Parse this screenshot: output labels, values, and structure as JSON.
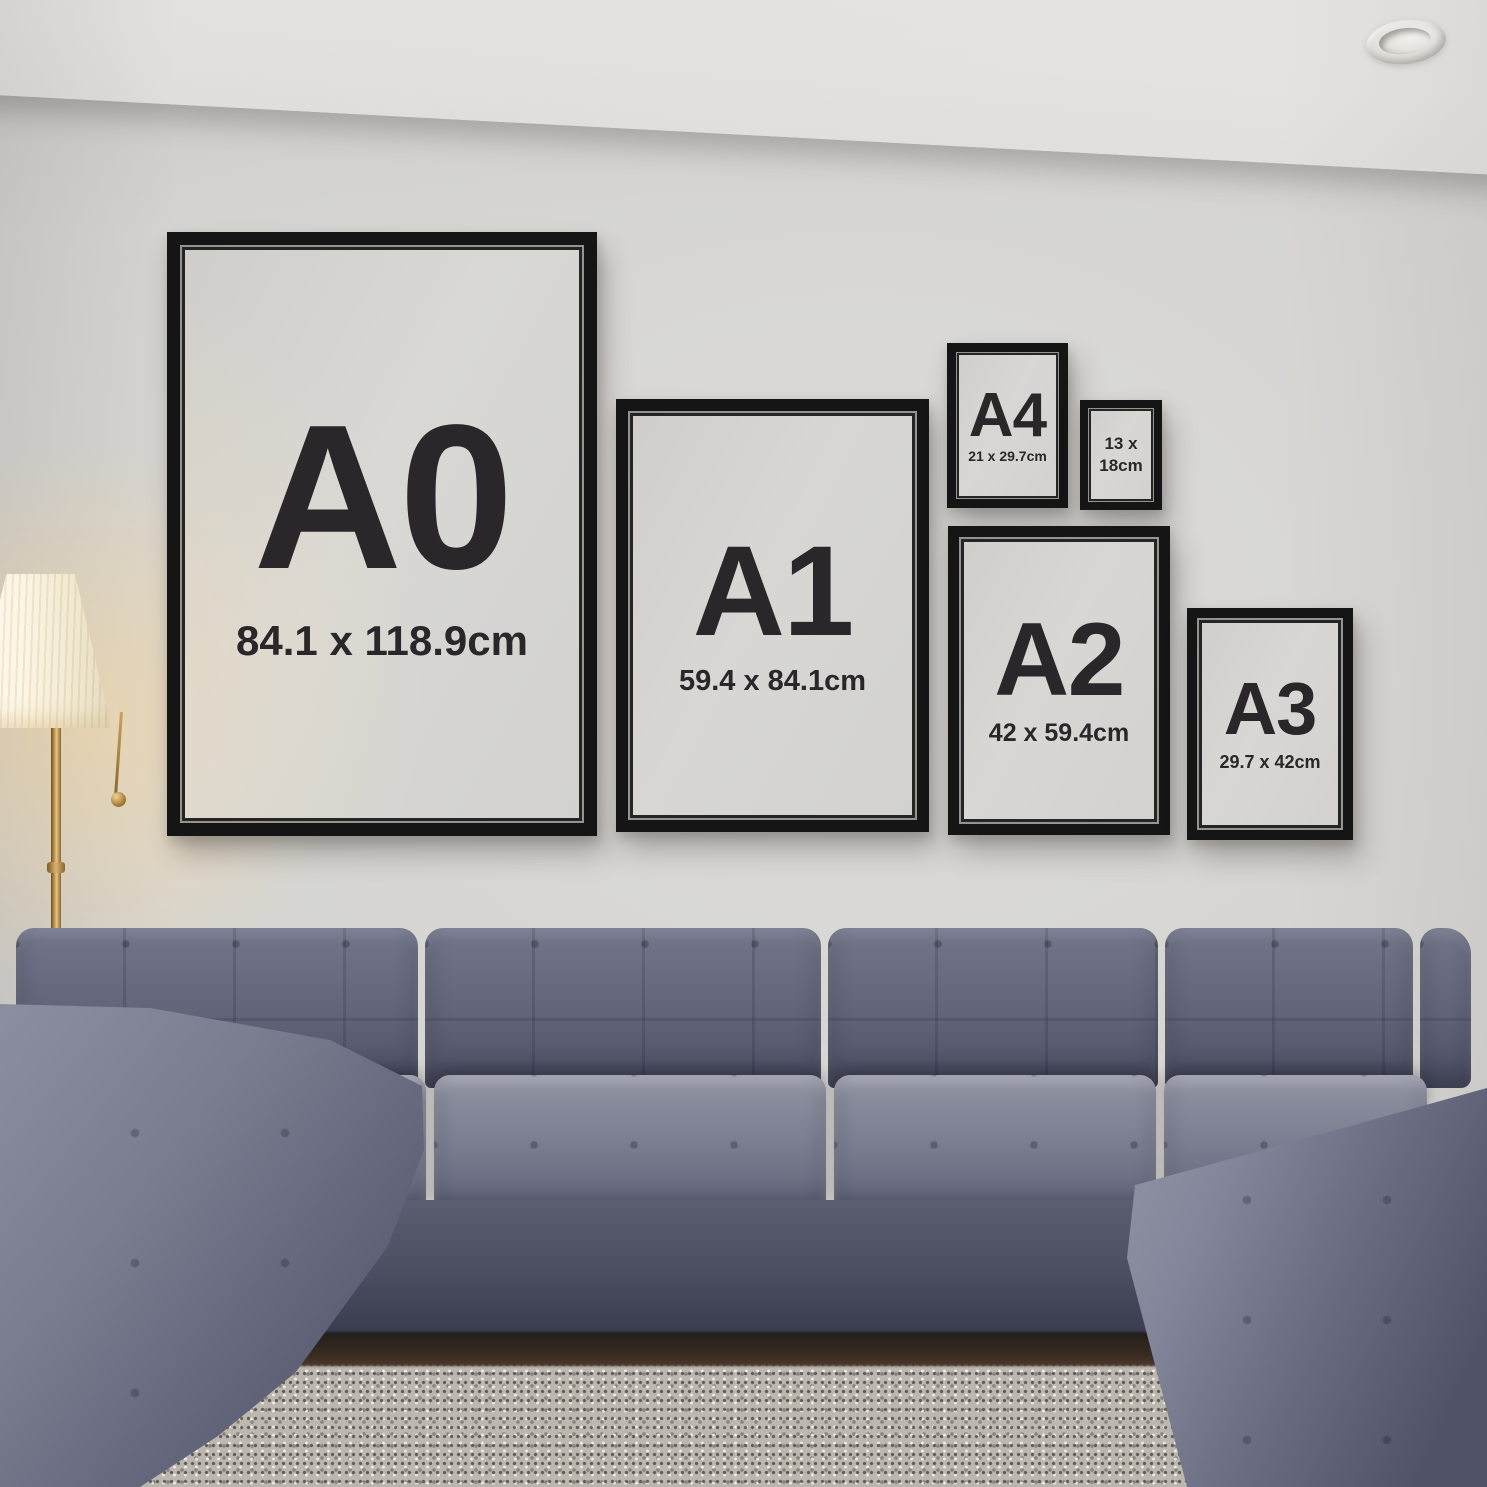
{
  "frames": [
    {
      "label": "A0",
      "size": "84.1 x 118.9cm"
    },
    {
      "label": "A1",
      "size": "59.4 x 84.1cm"
    },
    {
      "label": "A4",
      "size": "21 x 29.7cm"
    },
    {
      "label": "13 x",
      "size": "18cm"
    },
    {
      "label": "A2",
      "size": "42 x 59.4cm"
    },
    {
      "label": "A3",
      "size": "29.7 x 42cm"
    }
  ],
  "colors": {
    "wall": "#d6d5d2",
    "ceiling": "#edecE9",
    "frame": "#151515",
    "mat": "#d4d3d0",
    "text": "#2a262a",
    "sofa": "#666a7c",
    "rug": "#bcb8b0",
    "lamp_glow": "#ffdd9e",
    "brass": "#b48a4a"
  }
}
